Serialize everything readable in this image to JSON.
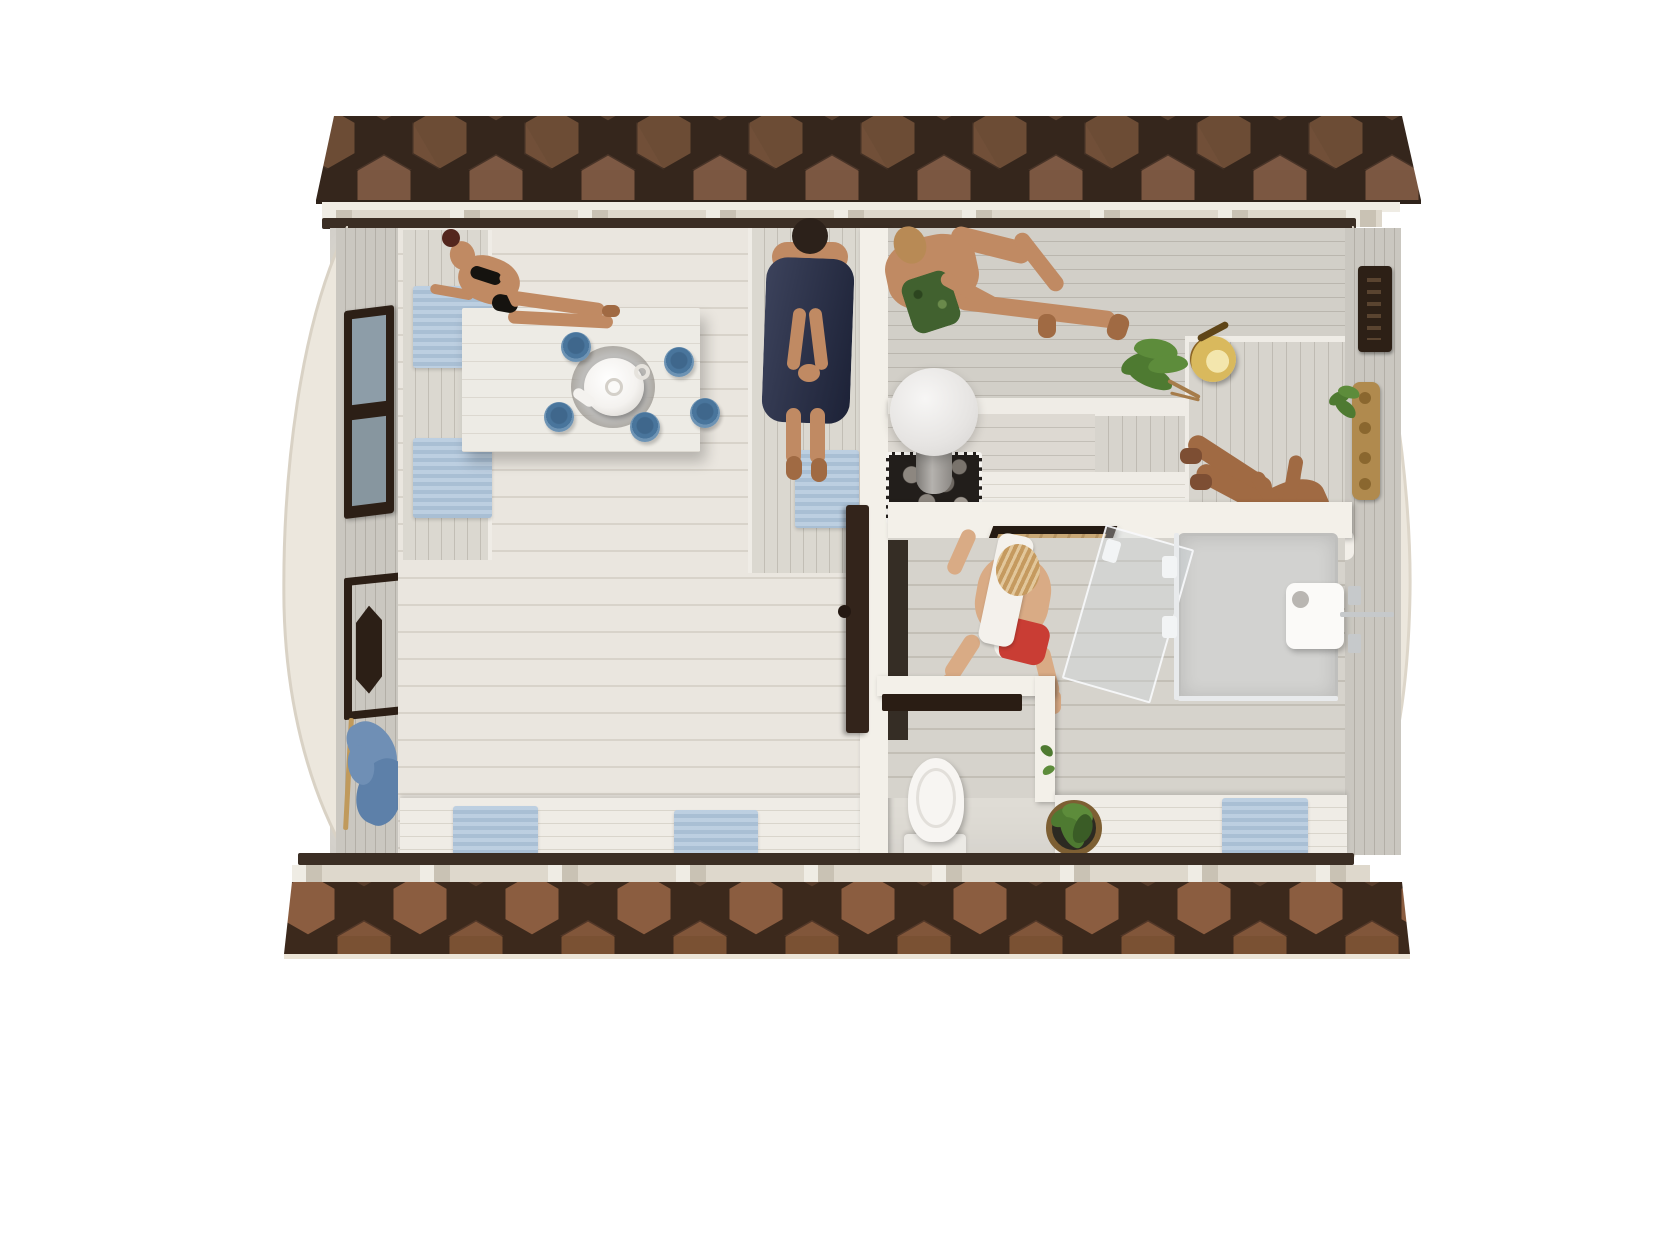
{
  "meta": {
    "description": "Top-down cutaway 3D render of a barrel-style sauna cabin with lounge, sauna room and washroom",
    "view": "overhead interior plan render",
    "visible_text": ""
  },
  "palette": {
    "bg": "#ffffff",
    "roofA": "#5a4130",
    "roofB": "#6c4c35",
    "roofC": "#7b5741",
    "roofD": "#4e382a",
    "roofE": "#83604a",
    "roofGap": "#35261c",
    "roofEdgeLine": "#2e221a",
    "roofFascia": "#efece4",
    "cream": "#ece7dd",
    "cutline": "#3b2e24",
    "fasciaShadow": "#c9c2b4",
    "floorLoungeA": "#eae6df",
    "floorLoungeB": "#d8d3ca",
    "benchA": "#dbd8d0",
    "benchB": "#c2beb5",
    "benchWhiteA": "#efece6",
    "benchWhiteB": "#d9d5cc",
    "saunaA": "#d2cfc8",
    "saunaB": "#bab6ae",
    "platA": "#d7d4cd",
    "platB": "#bfbbb3",
    "wallA": "#cac7c0",
    "wallB": "#b3afa7",
    "washA": "#d6d3cc",
    "washB": "#c3bfb6",
    "tableA": "#edebe5",
    "tableB": "#dcd8d0",
    "whiteWall": "#f3f0e9",
    "towel": "#aec5db",
    "navy": "#262d49",
    "robeBlue": "#6f8fb5",
    "robeBlueDark": "#5d80a9",
    "skin": "#c08a63",
    "skinPale": "#d9ab85",
    "skinDark": "#a06a43",
    "hairRed": "#53261d",
    "hairBlond": "#c59a5f",
    "hairDark": "#2c211a",
    "hairLightBrown": "#b88a55",
    "shortsGreen": "#41612f",
    "shortsRed": "#c93d34",
    "leaf": "#4e7a31",
    "leafLight": "#5d8c3b",
    "wood": "#c9a876",
    "woodStick": "#c09a5c",
    "rackWood": "#b08a4e",
    "doorDark": "#2c1f16",
    "glassPane": "#9fb4c2",
    "brass": "#8a6324",
    "brassLight": "#d9b95d",
    "brassHi": "#f3e6ad",
    "chrome": "#c6c9cb",
    "glass": "rgba(205,215,220,0.35)",
    "globeA": "#f7f6f5",
    "globeB": "#d4d2d0",
    "stoveDark": "#221e1b",
    "rock": "#8d8780",
    "chimney": "#9b9894",
    "tray": "#bdbcba",
    "teapot": "#f4f2ef",
    "cup": "#49759c",
    "cupDark": "#3f678c",
    "cupRim": "#6d93b4",
    "matDark": "#352d25"
  },
  "scene": {
    "building": "barrel sauna cabin, roof strips cut away top and bottom showing hexagonal shingles",
    "rooms": [
      {
        "name": "lounge",
        "features": [
          "white plank table with teapot on tray",
          "five blue cups",
          "side benches with blue towels",
          "window with dark frame",
          "entrance door with dark frame",
          "hanging blue robe and stick",
          "woman in black bikini",
          "person wrapped in navy towel"
        ]
      },
      {
        "name": "sauna",
        "features": [
          "tiered gray benches",
          "heater with white globe lamp and rock base",
          "birch whisk",
          "brass bucket",
          "man in green shorts",
          "man stretching on platform",
          "dark wall vent",
          "wooden rack",
          "small plant"
        ]
      },
      {
        "name": "washroom",
        "features": [
          "glass shower enclosure with white rain head",
          "chrome fittings",
          "toilet cubicle with toilet",
          "bench with blue towel",
          "plant basket",
          "man with white towel and red shorts"
        ]
      }
    ],
    "counts": {
      "people": 5,
      "teacups": 5,
      "blue_towels_and_mats": 6,
      "hanging_robes": 1
    },
    "materials": {
      "roof": "brown hexagonal shingles",
      "floors": "whitewashed pine planks",
      "walls": "pale grey pine"
    }
  }
}
